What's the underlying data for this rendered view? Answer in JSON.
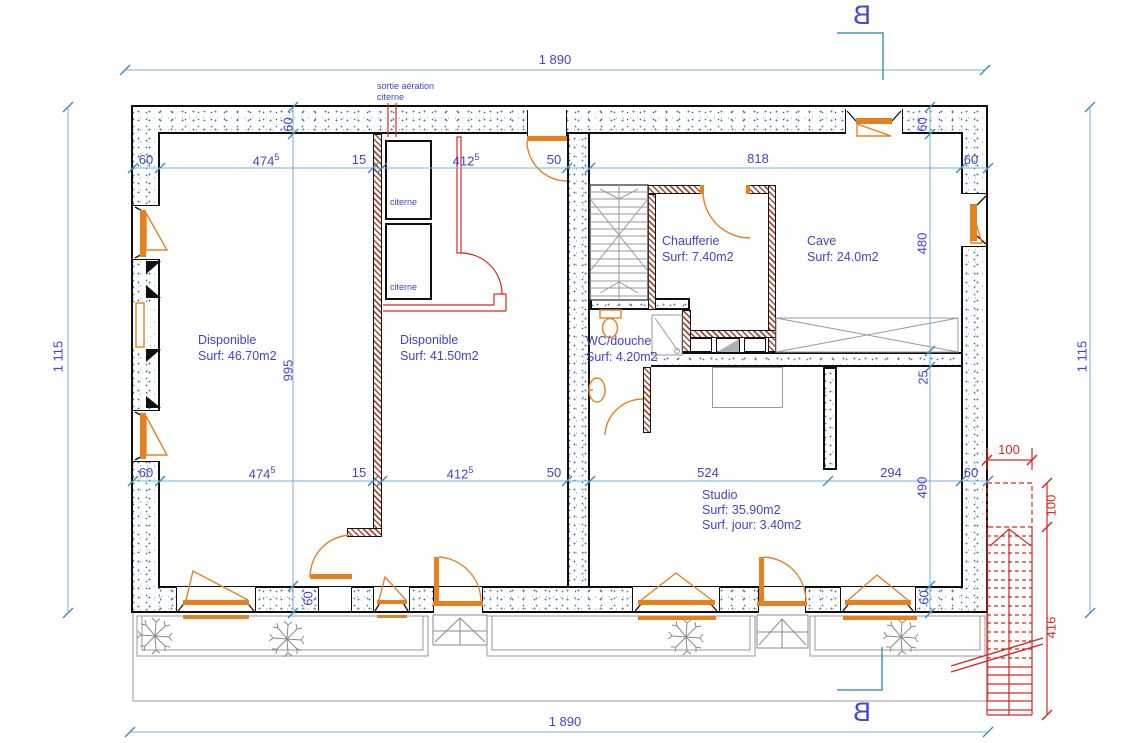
{
  "colors": {
    "dimension_text_blue": "#4243cf",
    "dimension_line_cyan": "#74b2d6",
    "window_orange": "#e5821f",
    "new_work_red": "#d42a1e",
    "wall_hatch_brown": "#a54a2e",
    "section_line_teal": "#3d9dae",
    "linework_gray": "#8a8a8a"
  },
  "section": {
    "label": "B"
  },
  "annotations": {
    "vent_line1": "sortie aération",
    "vent_line2": "citerne",
    "citerne": "citerne"
  },
  "rooms": {
    "disponible_left": {
      "name": "Disponible",
      "surface": "Surf: 46.70m2"
    },
    "disponible_mid": {
      "name": "Disponible",
      "surface": "Surf: 41.50m2"
    },
    "chaufferie": {
      "name": "Chaufferie",
      "surface": "Surf: 7.40m2"
    },
    "cave": {
      "name": "Cave",
      "surface": "Surf: 24.0m2"
    },
    "wc_douche": {
      "name": "WC/douche",
      "surface": "Surf: 4.20m2"
    },
    "studio": {
      "name": "Studio",
      "surface": "Surf: 35.90m2",
      "surface_day": "Surf. jour: 3.40m2"
    }
  },
  "dimensions": {
    "w1890": "1 890",
    "h1115": "1 115",
    "d60": "60",
    "d474": "474",
    "d412": "412",
    "sup5": "5",
    "d15": "15",
    "d50": "50",
    "d818": "818",
    "d524": "524",
    "d294": "294",
    "d995": "995",
    "d480": "480",
    "d25": "25",
    "d490": "490",
    "d100": "100",
    "d416": "416"
  }
}
